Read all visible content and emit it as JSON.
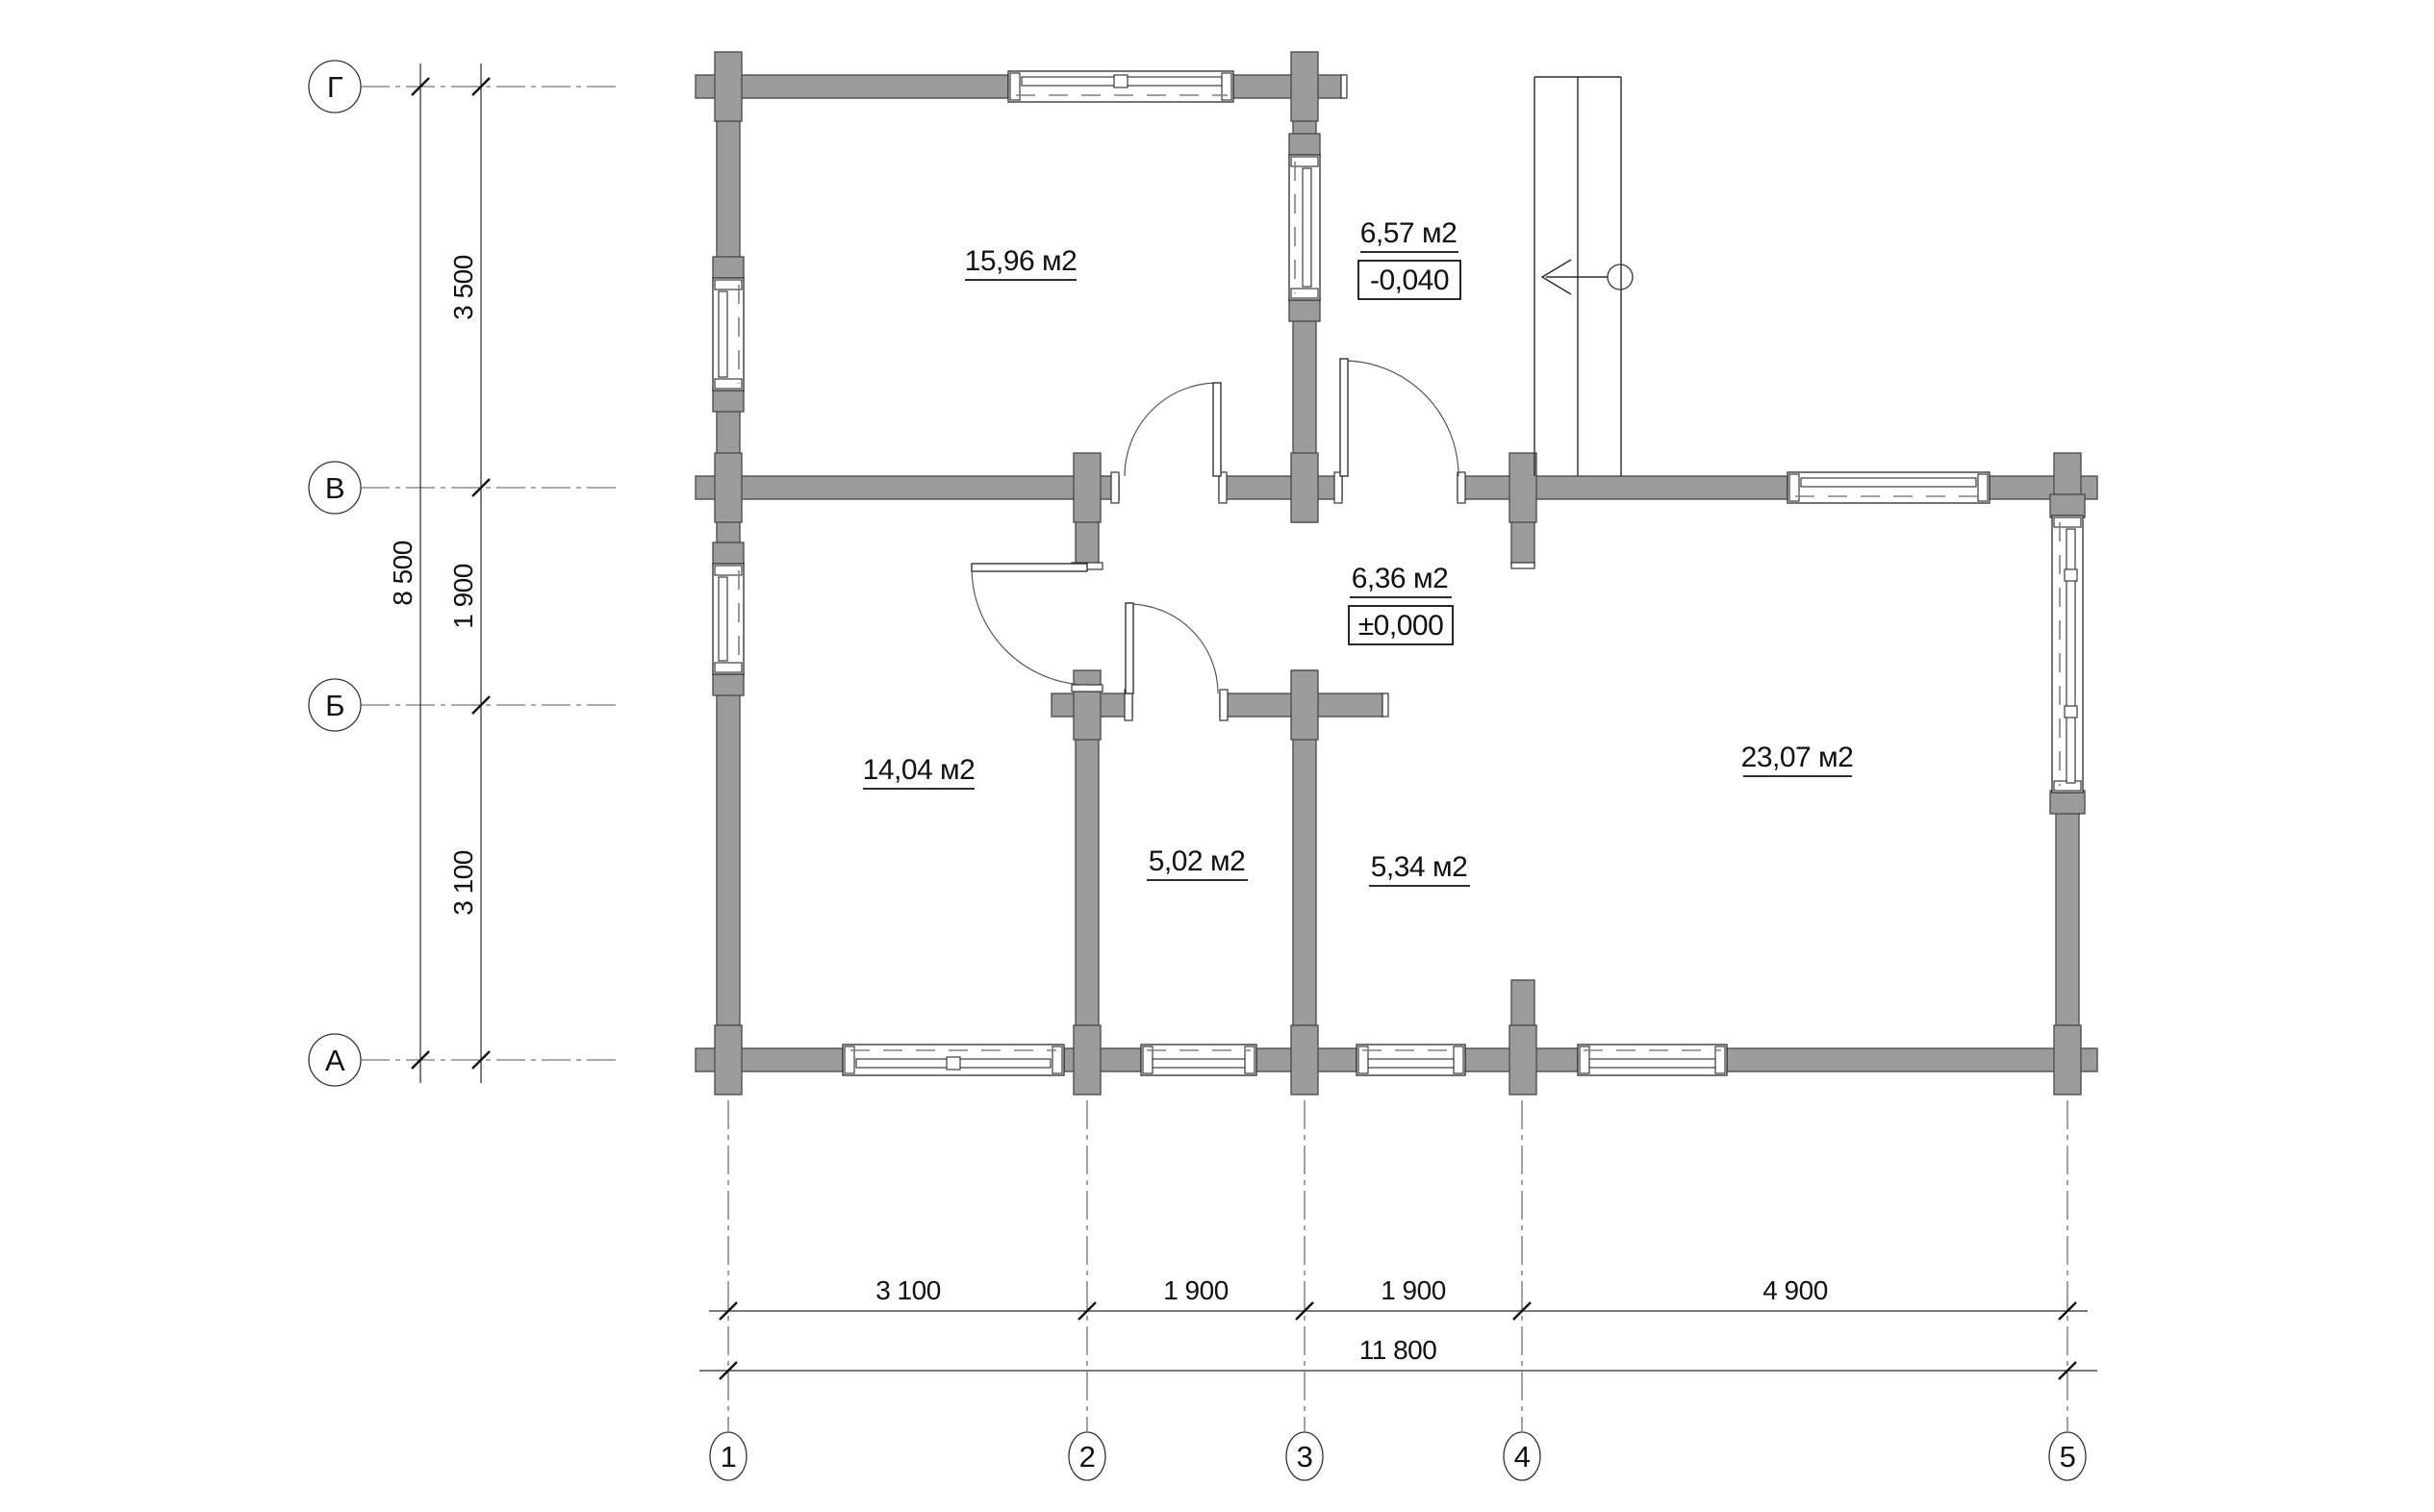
{
  "title": "floor-plan",
  "colors": {
    "wall_fill": "#9b9b9b",
    "wall_stroke": "#4f4f4f",
    "line": "#2a2a2a"
  },
  "rooms": [
    {
      "name": "room-top-left",
      "area": "15,96 м2"
    },
    {
      "name": "porch",
      "area": "6,57 м2",
      "level": "-0,040"
    },
    {
      "name": "hall",
      "area": "6,36 м2",
      "level": "±0,000"
    },
    {
      "name": "room-bottom-left",
      "area": "14,04 м2"
    },
    {
      "name": "room-small-1",
      "area": "5,02 м2"
    },
    {
      "name": "room-small-2",
      "area": "5,34 м2"
    },
    {
      "name": "living-room",
      "area": "23,07 м2"
    }
  ],
  "axes": {
    "horizontal": [
      {
        "label": "Г"
      },
      {
        "label": "В"
      },
      {
        "label": "Б"
      },
      {
        "label": "А"
      }
    ],
    "vertical": [
      {
        "label": "1"
      },
      {
        "label": "2"
      },
      {
        "label": "3"
      },
      {
        "label": "4"
      },
      {
        "label": "5"
      }
    ]
  },
  "dimensions": {
    "left_segments": [
      "3 500",
      "1 900",
      "3 100"
    ],
    "left_total": "8 500",
    "bottom_segments": [
      "3 100",
      "1 900",
      "1 900",
      "4 900"
    ],
    "bottom_total": "11 800"
  }
}
